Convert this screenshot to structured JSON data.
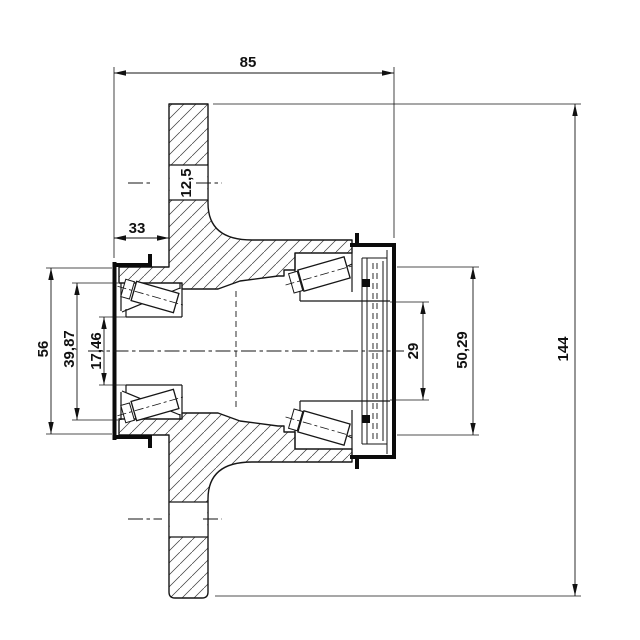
{
  "drawing": {
    "kind": "technical-section-drawing",
    "subject": "wheel hub with two tapered roller bearings, seal and cap",
    "colors": {
      "line": "#161616",
      "background": "#ffffff",
      "hatch": "#3a3a3a"
    },
    "dims": [
      {
        "id": "overall-width",
        "value": "85",
        "orientation": "horizontal"
      },
      {
        "id": "seal-to-flange",
        "value": "33",
        "orientation": "horizontal"
      },
      {
        "id": "bolt-hole",
        "value": "12,5",
        "orientation": "vertical"
      },
      {
        "id": "seal-seat-od",
        "value": "56",
        "orientation": "vertical"
      },
      {
        "id": "left-bearing-od",
        "value": "39,87",
        "orientation": "vertical"
      },
      {
        "id": "bore-id",
        "value": "17,46",
        "orientation": "vertical"
      },
      {
        "id": "seal-ring-id",
        "value": "29",
        "orientation": "vertical"
      },
      {
        "id": "right-bearing-od",
        "value": "50,29",
        "orientation": "vertical"
      },
      {
        "id": "flange-diameter",
        "value": "144",
        "orientation": "vertical"
      }
    ]
  }
}
